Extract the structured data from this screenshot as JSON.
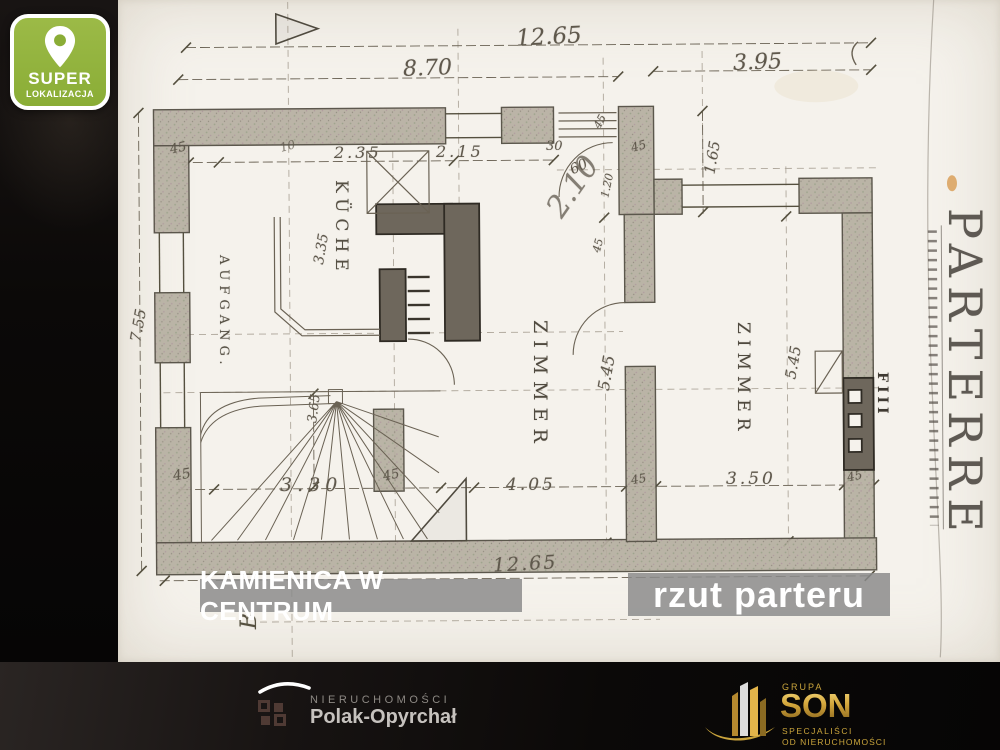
{
  "badge": {
    "title": "SUPER",
    "subtitle": "LOKALIZACJA"
  },
  "overlays": {
    "left": "KAMIENICA W CENTRUM",
    "right": "rzut parteru"
  },
  "plan": {
    "rooms": {
      "kitchen": "KÜCHE",
      "room_left": "ZIMMER",
      "room_right": "ZIMMER",
      "stair_hall": "AUFGANG.",
      "floor": "PARTERRE",
      "wall_note": "FIII",
      "section_marker": "B"
    },
    "dimensions": {
      "top_total": "12.65",
      "top_left": "8.70",
      "top_right": "3.95",
      "wall_45_top_left": "45",
      "note_10": "10",
      "kitchen_width_a": "2.35",
      "kitchen_width_b": "2.15",
      "porch_30": "30",
      "porch_45_a": "45",
      "porch_45_b": "45",
      "porch_60": "60",
      "porch_120": "1.20",
      "porch_45_c": "45",
      "setback_height": "1.65",
      "handwritten": "2.10",
      "kitchen_depth": "3.35",
      "left_height": "7.55",
      "room_left_depth": "5.45",
      "room_right_depth": "5.45",
      "stair_45_left": "45",
      "stair_width": "3.30",
      "stair_depth": "3.65",
      "stair_45_right": "45",
      "room_left_width": "4.05",
      "mid_wall_45": "45",
      "room_right_width": "3.50",
      "right_wall_45": "45",
      "bottom_total": "12.65"
    }
  },
  "footer": {
    "agency": {
      "line1": "NIERUCHOMOŚCI",
      "line2": "Polak-Opyrchał"
    },
    "group": {
      "name_top": "GRUPA",
      "name": "SON",
      "tagline1": "SPECJALIŚCI",
      "tagline2": "OD NIERUCHOMOŚCI"
    }
  },
  "colors": {
    "badge_green": "#8aad36",
    "overlay_gray": "#8a8a8a",
    "gold": "#d4a73c",
    "paper": "#f5f2ec"
  }
}
